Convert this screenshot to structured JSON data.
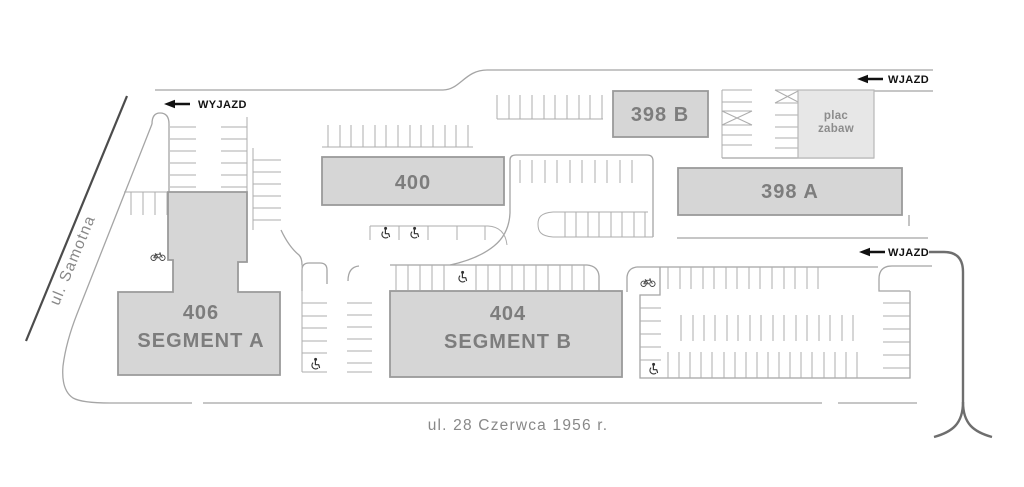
{
  "labels": {
    "wyjazd": "WYJAZD",
    "wjazd_top": "WJAZD",
    "wjazd_right": "WJAZD",
    "street_left": "ul. Samotna",
    "street_bottom": "ul. 28 Czerwca 1956 r."
  },
  "buildings": {
    "b398b": "398 B",
    "b398a": "398 A",
    "b400": "400",
    "b404_number": "404",
    "b404_segment": "SEGMENT B",
    "b406_number": "406",
    "b406_segment": "SEGMENT A"
  },
  "playground": {
    "line1": "plac",
    "line2": "zabaw"
  },
  "colors": {
    "building_fill": "#d6d6d6",
    "building_stroke": "#9a9a9a",
    "building_label": "#7d7d7d",
    "playground_fill": "#e7e7e7",
    "playground_stroke": "#b8b8b8",
    "playground_label": "#8c8c8c",
    "stall_line": "#adadad",
    "road_line": "#a5a5a5",
    "street_dark": "#4c4c4c",
    "road_dark": "#6e6e6e",
    "label_black": "#111111",
    "street_label": "#888888"
  }
}
